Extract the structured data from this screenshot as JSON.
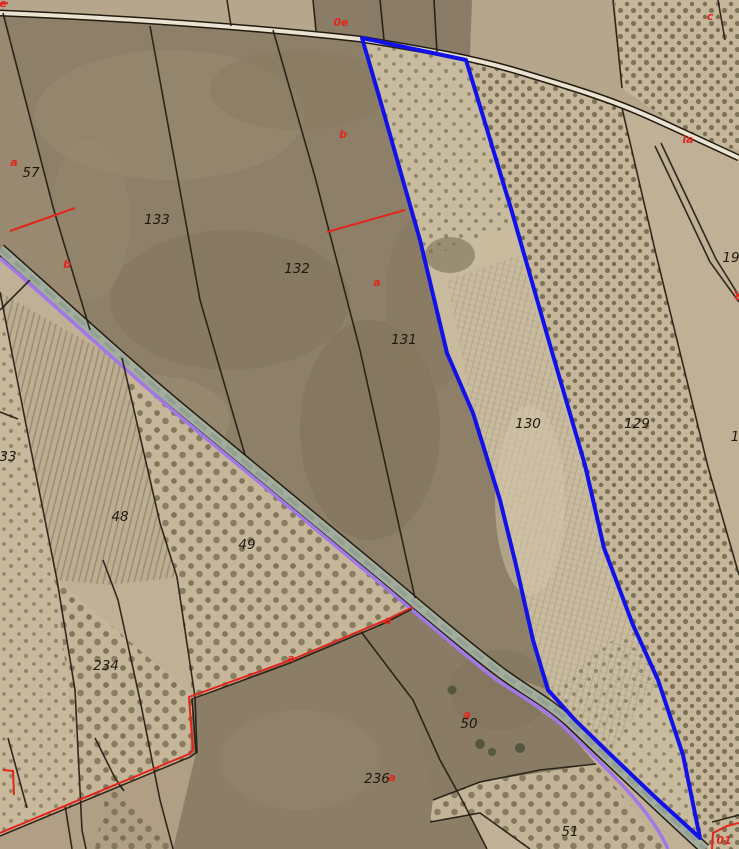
{
  "map": {
    "type": "cadastral-aerial-view",
    "highlighted_parcel_label": "130",
    "parcel_labels": [
      {
        "text": "57",
        "x": 31,
        "y": 177
      },
      {
        "text": "133",
        "x": 157,
        "y": 224
      },
      {
        "text": "132",
        "x": 297,
        "y": 273
      },
      {
        "text": "131",
        "x": 404,
        "y": 344
      },
      {
        "text": "130",
        "x": 528,
        "y": 428
      },
      {
        "text": "129",
        "x": 637,
        "y": 428
      },
      {
        "text": "48",
        "x": 120,
        "y": 521
      },
      {
        "text": "49",
        "x": 247,
        "y": 549
      },
      {
        "text": "234",
        "x": 106,
        "y": 670
      },
      {
        "text": "236",
        "x": 377,
        "y": 783
      },
      {
        "text": "50",
        "x": 469,
        "y": 728
      },
      {
        "text": "51",
        "x": 570,
        "y": 836
      },
      {
        "text": "33",
        "x": 8,
        "y": 461
      },
      {
        "text": "19",
        "x": 731,
        "y": 262
      },
      {
        "text": "1",
        "x": 735,
        "y": 441
      }
    ],
    "subparcel_labels": [
      {
        "text": "a",
        "x": 14,
        "y": 166
      },
      {
        "text": "b",
        "x": 67,
        "y": 268
      },
      {
        "text": "0e",
        "x": 341,
        "y": 26
      },
      {
        "text": "b",
        "x": 343,
        "y": 138
      },
      {
        "text": "a",
        "x": 377,
        "y": 286
      },
      {
        "text": "c",
        "x": 710,
        "y": 20
      },
      {
        "text": "la",
        "x": 688,
        "y": 143
      },
      {
        "text": "a",
        "x": 467,
        "y": 718
      },
      {
        "text": "a",
        "x": 291,
        "y": 662
      },
      {
        "text": "a",
        "x": 388,
        "y": 624
      },
      {
        "text": "a",
        "x": 392,
        "y": 781
      },
      {
        "text": "01",
        "x": 724,
        "y": 844
      },
      {
        "text": "e",
        "x": 3,
        "y": 7
      },
      {
        "text": "c",
        "x": 738,
        "y": 300
      }
    ],
    "colors": {
      "highlight_blue": "#1212e8",
      "subparcel_red": "#e3261c",
      "road_edge_purple": "#a178e6",
      "boundary_black": "#241c12",
      "field_tan": "#c0b095",
      "field_brown": "#8e8068"
    }
  }
}
